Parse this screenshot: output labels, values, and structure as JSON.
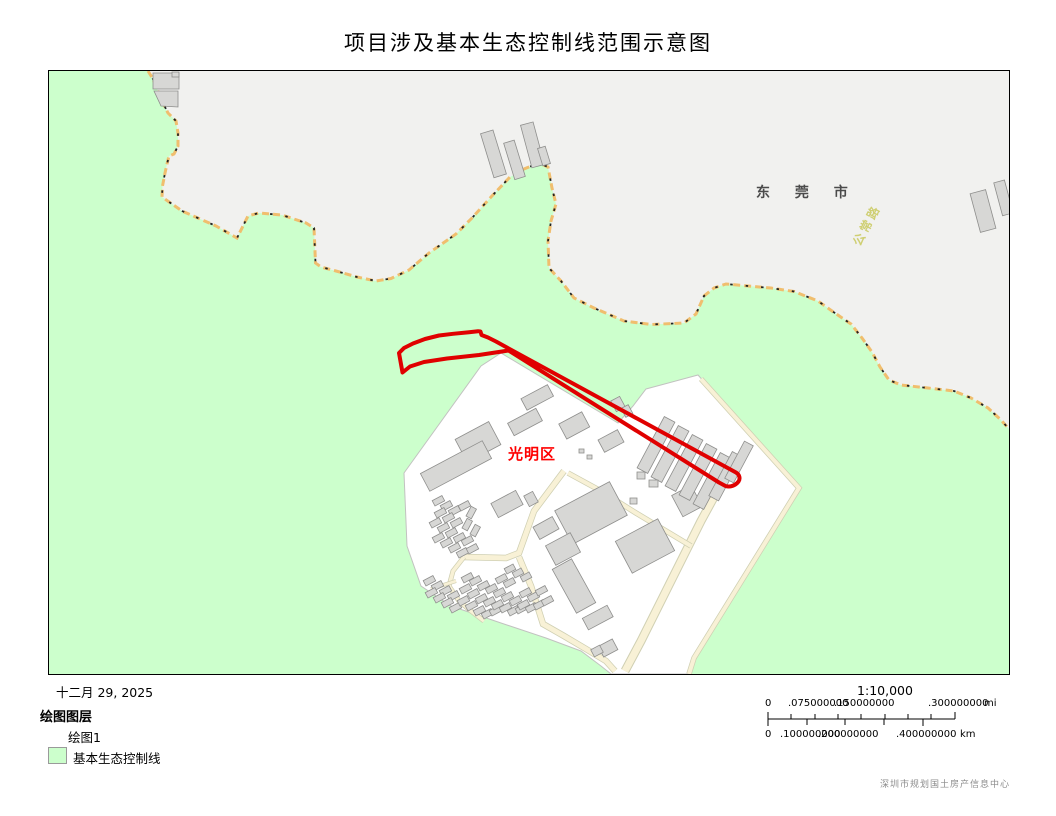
{
  "title": "项目涉及基本生态控制线范围示意图",
  "map": {
    "labels": {
      "city": "东 莞 市",
      "road": "公常路",
      "district": "光明区"
    },
    "colors": {
      "eco_green": "#ccffcc",
      "outside_gray": "#f1f1ef",
      "boundary_orange": "#f0be6e",
      "boundary_black": "#222222",
      "project_red": "#e00000",
      "urban_white": "#ffffff",
      "road_cream": "#f8f1d6",
      "building_gray": "#d7d7d5"
    }
  },
  "footer": {
    "date": "十二月 29, 2025",
    "legend": {
      "title": "绘图图层",
      "items": [
        {
          "label": "绘图1"
        },
        {
          "label": "基本生态控制线",
          "swatch": "#ccffcc"
        }
      ]
    },
    "scale": {
      "ratio": "1:10,000",
      "mi_labels": [
        "0",
        ".075000000",
        ".150000000",
        ".300000000"
      ],
      "mi_unit": "mi",
      "km_labels": [
        "0",
        ".100000000",
        ".200000000",
        ".400000000"
      ],
      "km_unit": "km"
    },
    "credit": "深圳市规划国土房产信息中心"
  }
}
